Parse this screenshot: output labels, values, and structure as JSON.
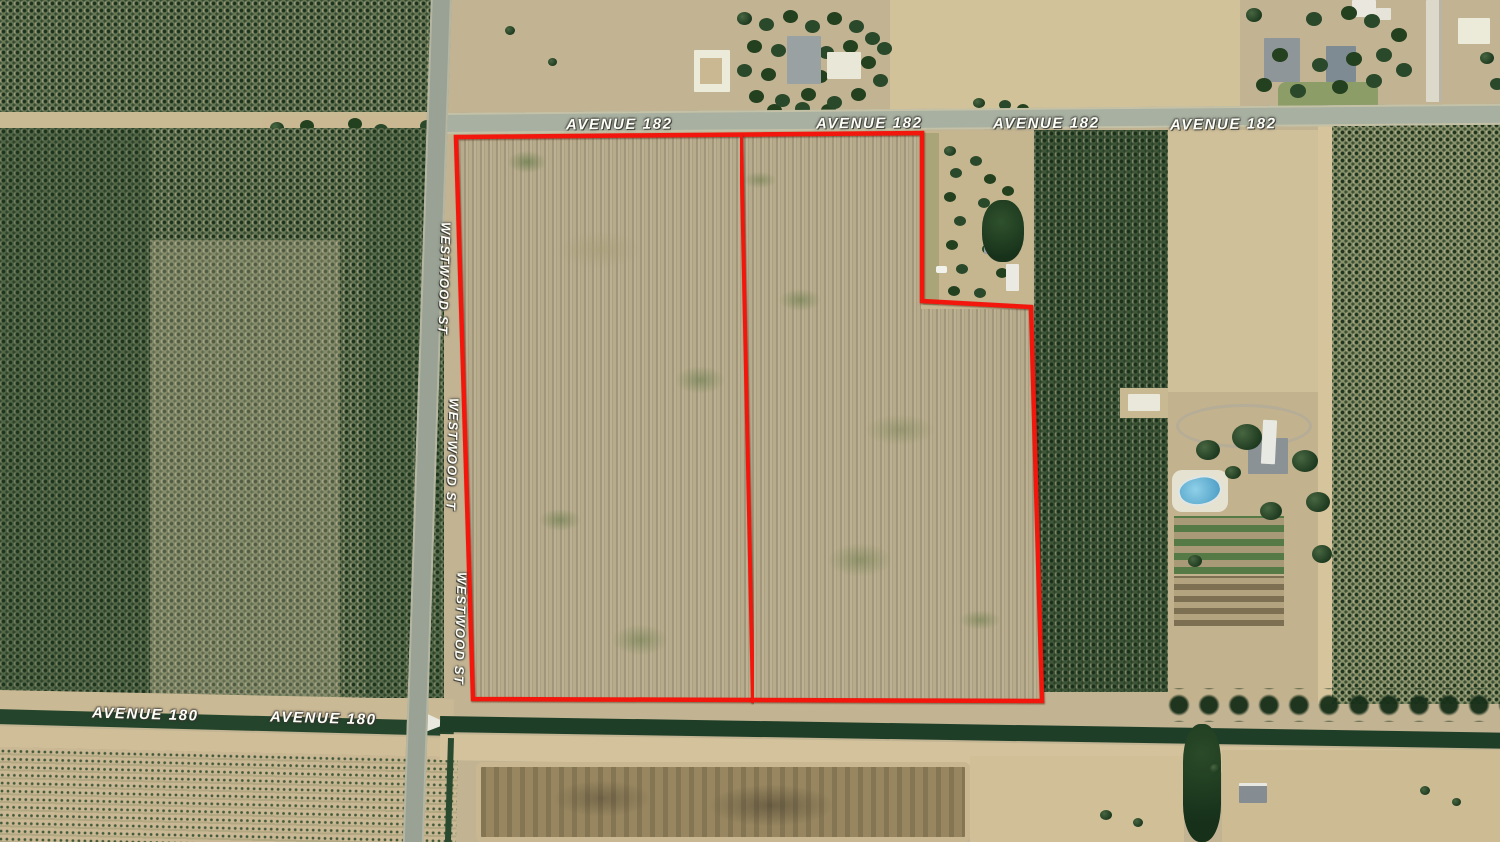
{
  "map": {
    "description": "Aerial satellite view of two farmland parcels outlined in red at Avenue 182 and Westwood St",
    "road_labels": {
      "avenue_182": "AVENUE 182",
      "westwood_st": "WESTWOOD ST",
      "avenue_180": "AVENUE 180"
    },
    "label_counts": {
      "avenue_182": 4,
      "westwood_st": 3,
      "avenue_180": 2
    },
    "boundary": {
      "color": "#f2190c",
      "parcel_count": 2,
      "outline_points": "456,137 922,133 922,301 1031,307 1042,701 473,699",
      "divider": {
        "x1": 741,
        "y1": 135,
        "x2": 753,
        "y2": 703
      }
    },
    "colors": {
      "orchard_green": "#42583b",
      "field_tan": "#b3a88a",
      "canal_dark_green": "#20402a",
      "road_gray": "#a8b0a1",
      "pool_blue": "#6ab5d8",
      "boundary_red": "#f2190c"
    }
  }
}
